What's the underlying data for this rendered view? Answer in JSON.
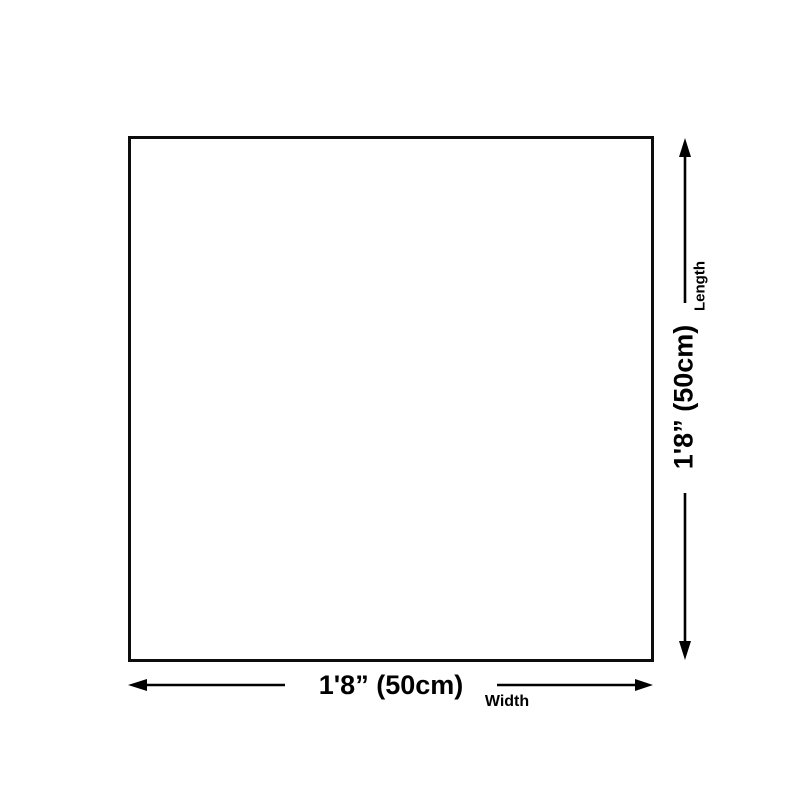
{
  "diagram": {
    "type": "product-dimension-diagram",
    "shape": "square",
    "width": {
      "value": "1'8” (50cm)",
      "label": "Width"
    },
    "length": {
      "value": "1'8” (50cm)",
      "label": "Length"
    },
    "colors": {
      "background": "#ffffff",
      "square_fill": "#ffffff",
      "square_border": "#0d0d0d",
      "line": "#000000",
      "text": "#000000"
    }
  }
}
